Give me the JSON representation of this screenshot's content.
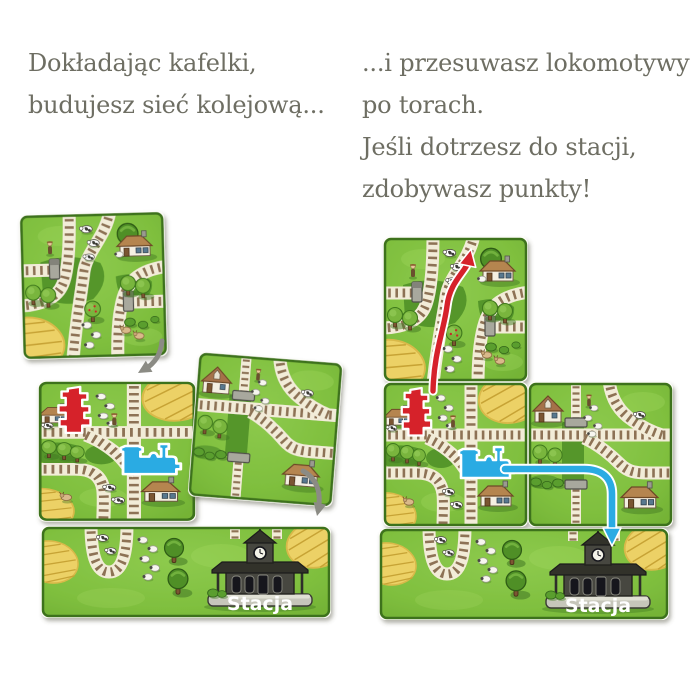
{
  "captions": {
    "left": {
      "lines": [
        "Dokładając kafelki,",
        "budujesz sieć kolejową..."
      ]
    },
    "right": {
      "lines": [
        "...i przesuwasz lokomotywy",
        "po torach.",
        "Jeśli dotrzesz do stacji,",
        "zdobywasz punkty!"
      ]
    }
  },
  "stations": {
    "left_label": "Stacja",
    "right_label": "Stacja"
  },
  "icons": {
    "locomotive": "blue steam engine silhouette",
    "red_building": "red jagged building silhouette",
    "station": "dark station house with clock tower",
    "placement_arrow": "gray curved arrow",
    "red_route_arrow": "red arrow along track",
    "blue_route_arrow": "blue arrow along track"
  },
  "colors": {
    "caption_text": "#6e6e63",
    "tile_green": "#7fbf3e",
    "tile_border": "#3e721d",
    "dark_meadow": "#55962c",
    "track_bed": "#f2ecd8",
    "track_tie": "#8d7254",
    "hay": "#ecd166",
    "red_accent": "#d6212b",
    "blue_accent": "#2aabe3",
    "gray_arrow": "#8b8b84",
    "station_building": "#474741",
    "station_label": "#ffffff"
  }
}
